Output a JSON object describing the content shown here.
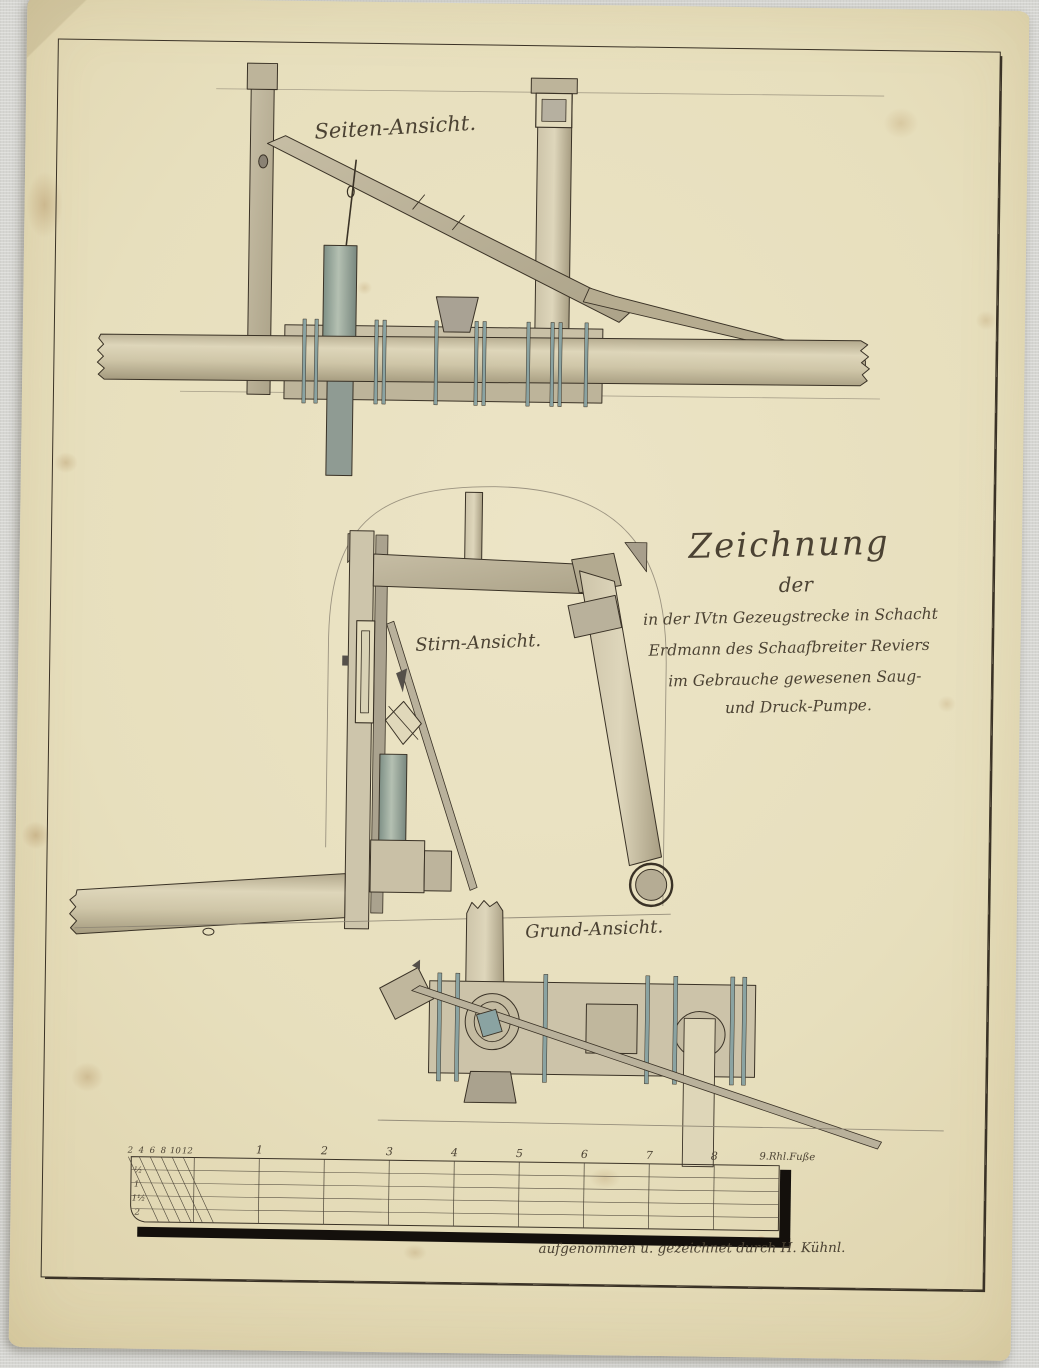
{
  "drawing": {
    "views": {
      "side": {
        "label": "Seiten-Ansicht."
      },
      "front": {
        "label": "Stirn-Ansicht."
      },
      "plan": {
        "label": "Grund-Ansicht."
      }
    },
    "title_block": {
      "line1": "Zeichnung",
      "line2": "der",
      "line3": "in der IVtn Gezeugstrecke in Schacht",
      "line4": "Erdmann des Schaafbreiter Reviers",
      "line5": "im Gebrauche gewesenen Saug-",
      "line6": "und Druck-Pumpe."
    },
    "scale_bar": {
      "inch_labels": [
        "2",
        "4",
        "6",
        "8",
        "10",
        "12"
      ],
      "foot_labels": [
        "1",
        "2",
        "3",
        "4",
        "5",
        "6",
        "7",
        "8"
      ],
      "unit_label": "9.Rhl.Fuße",
      "row_labels": [
        "½",
        "1",
        "1½",
        "2"
      ]
    },
    "credit": "aufgenommen u. gezeichnet durch H. Kühnl.",
    "colors": {
      "background": "#d6d6d2",
      "paper": "#e7dfbd",
      "paper_edge": "#d5c89d",
      "ink": "#3a3226",
      "script_ink": "#4b4233",
      "wash_wood": "#c2b99f",
      "wash_pipe": "#cdc4a8",
      "wash_cylinder": "#93a39a",
      "wash_strap": "#8aa3a2",
      "shadow_band": "#14100c"
    }
  }
}
